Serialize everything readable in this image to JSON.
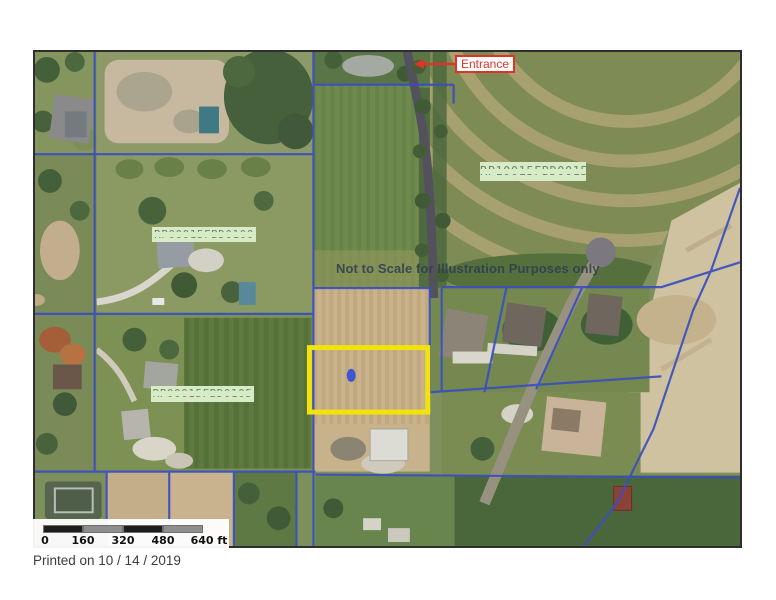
{
  "map": {
    "entrance": {
      "label": "Entrance"
    },
    "disclaimer": "Not to Scale for Illustration Purposes only",
    "parcel_labels": [
      {
        "text": "RP10015FBD0015"
      },
      {
        "text": "RP00015FBD0100"
      },
      {
        "text": "RP00015FBD0105"
      }
    ],
    "scale_bar": {
      "tick_labels": [
        "0",
        "160",
        "320",
        "480",
        "640 ft"
      ],
      "segment_colors": [
        "#1d1d1d",
        "#8e8e8e",
        "#1d1d1d",
        "#8e8e8e"
      ]
    },
    "colors": {
      "parcel_line": "#3a4fc0",
      "highlight_outline": "#f2e30e",
      "highlight_marker": "#4055d4",
      "entrance_red": "#e03328",
      "parcel_label_bg": "#d7ecc6"
    }
  },
  "footer": {
    "printed_on": "Printed on 10 / 14 / 2019"
  }
}
